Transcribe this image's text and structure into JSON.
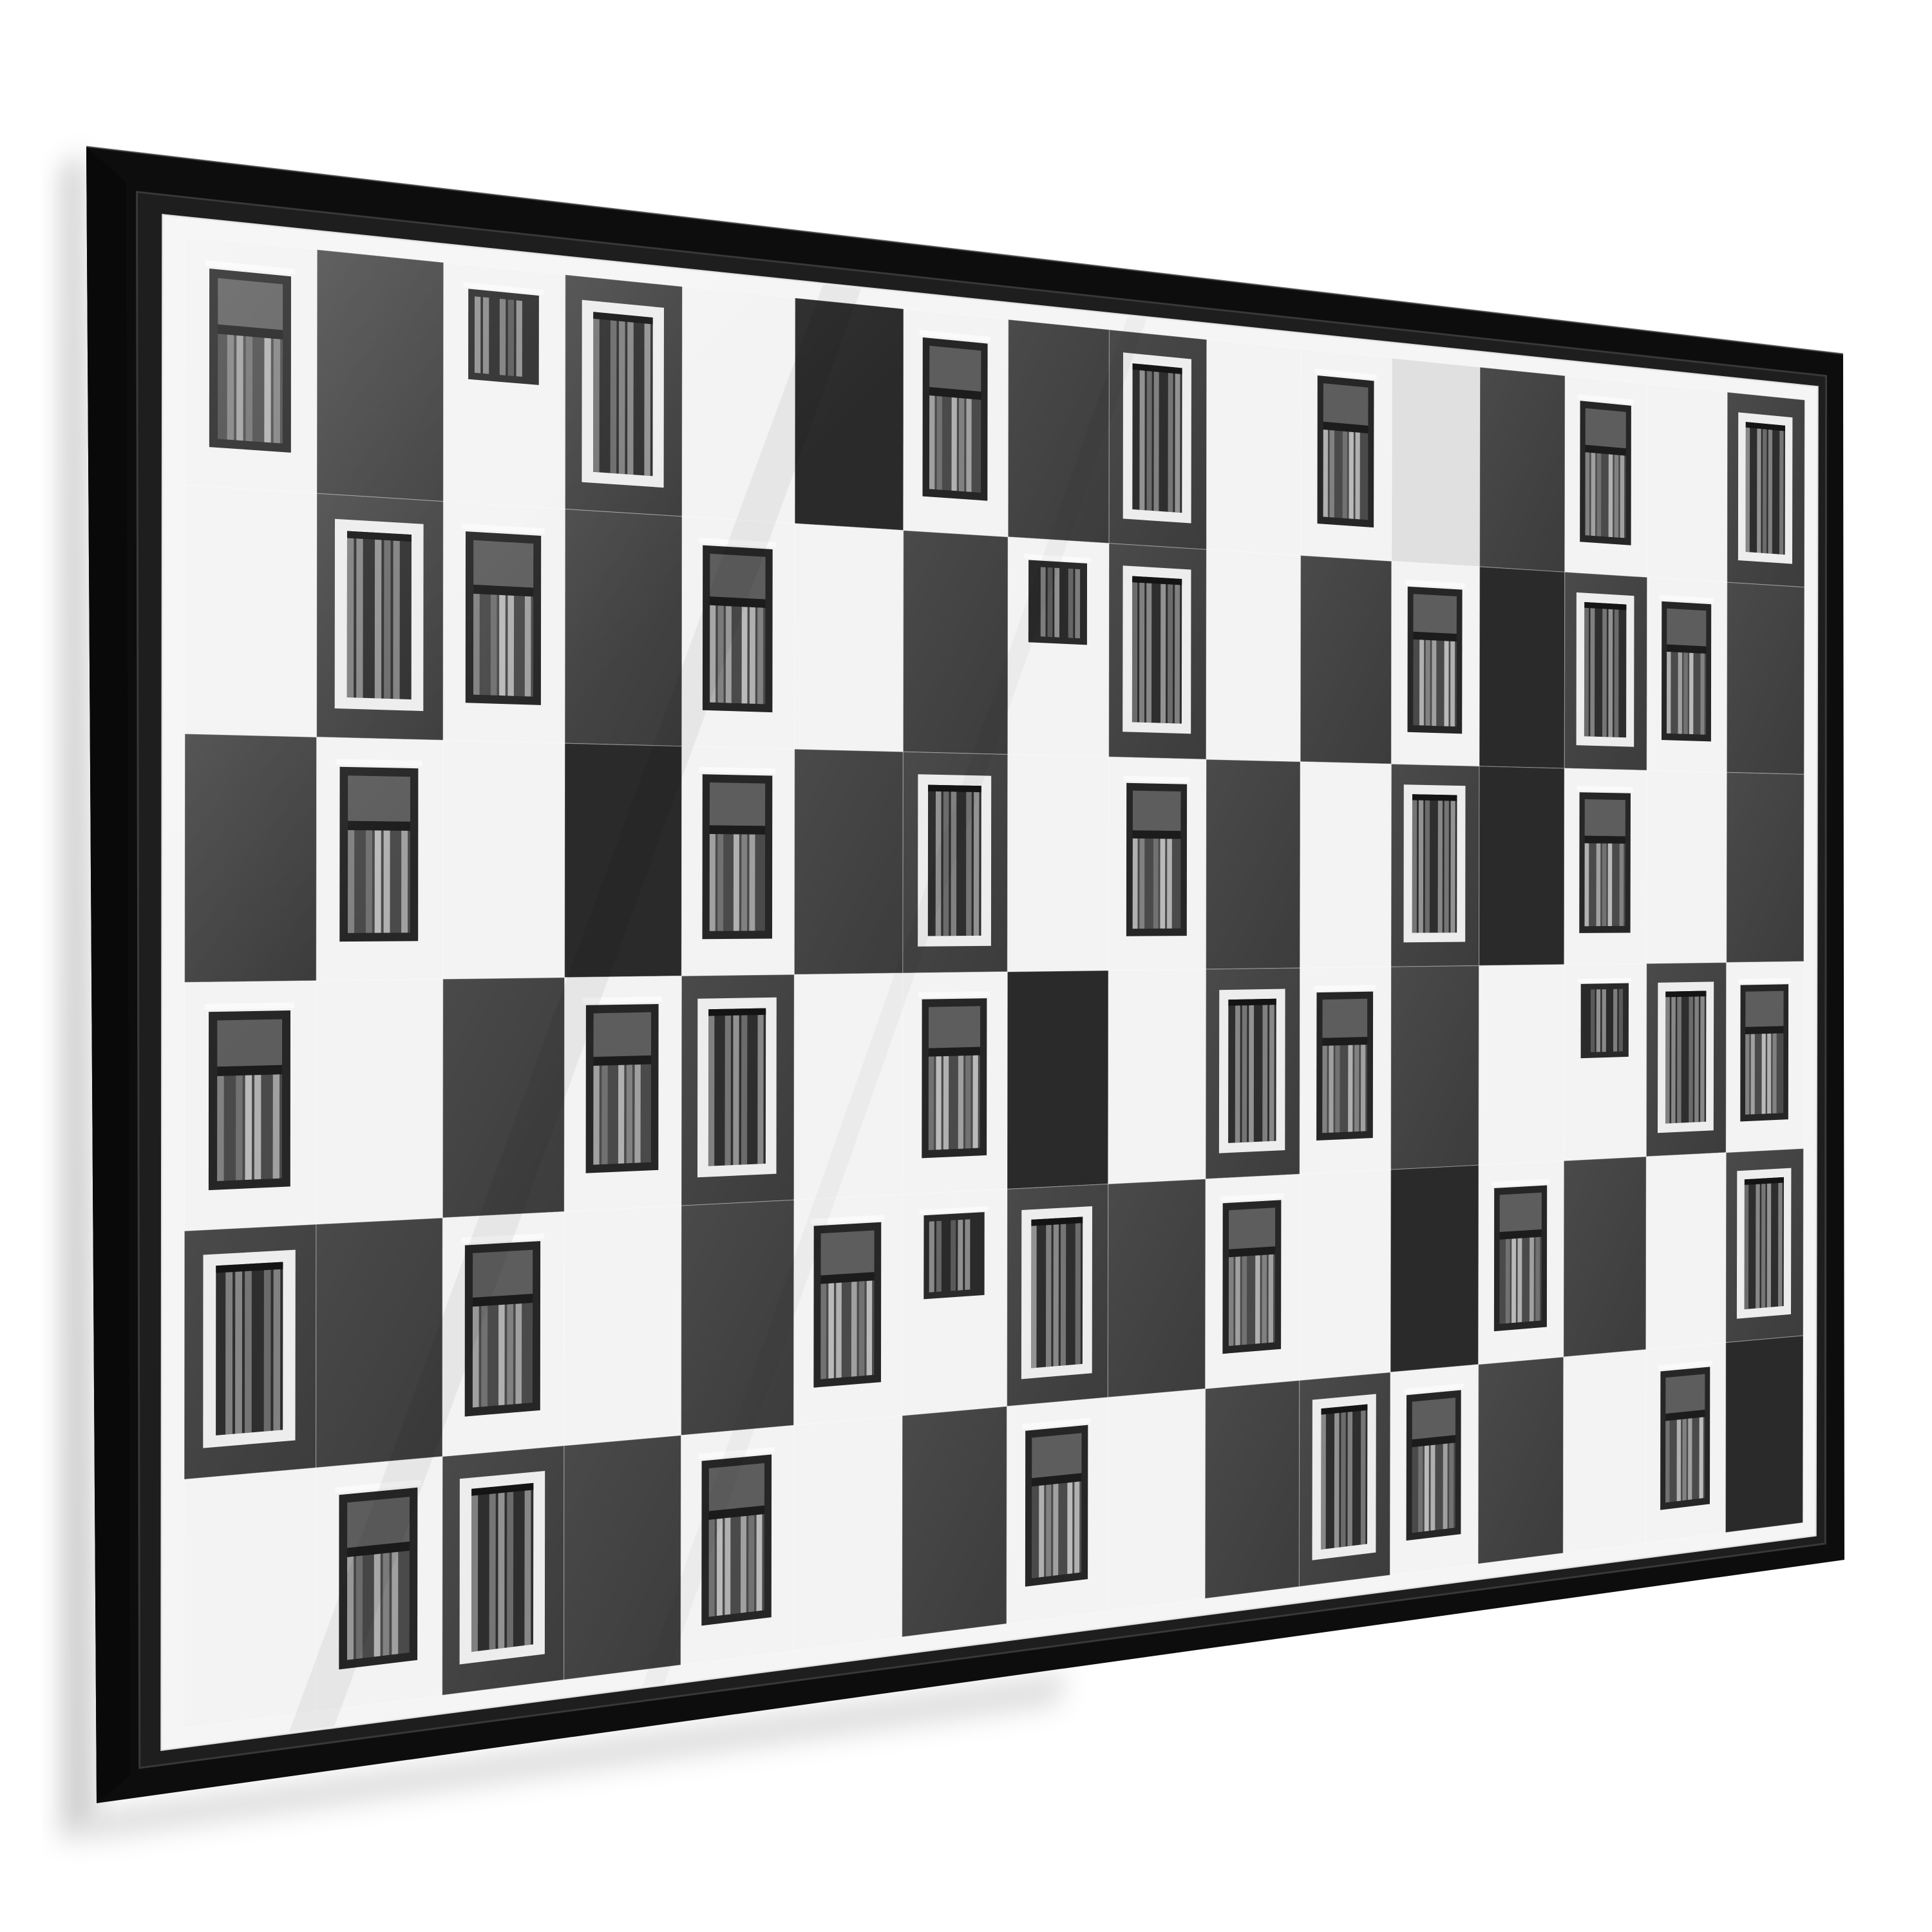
{
  "scene": {
    "wall_color": "#ffffff",
    "shadow_color": "#000000"
  },
  "poster": {
    "frame_color": "#0d0d0d",
    "frame_side_color": "#090909",
    "frame_lip_color": "#1e1e1e",
    "frame_lip_highlight": "#3c3c3c",
    "glass_edge_color": "#f2f2f2",
    "print_paper_color": "#f5f5f5",
    "outer_quad": [
      [
        134,
        228
      ],
      [
        2862,
        550
      ],
      [
        2864,
        2422
      ],
      [
        150,
        2800
      ]
    ],
    "inner_quad": [
      [
        253,
        334
      ],
      [
        2822,
        601
      ],
      [
        2819,
        2384
      ],
      [
        251,
        2717
      ]
    ],
    "source_size": [
      2560,
      2100
    ],
    "print_margin": 26,
    "grid": {
      "cols": 16,
      "rows": 6,
      "cells": [
        "KDSCWBKDCWKLDKWC",
        "WCKDKWDSCWDKBCKD",
        "DKWBKDCWKDWCBKWD",
        "KWDKCWKBWCKDWSCK",
        "CDKWDKSCDKWBKDWC",
        "WKCDKWDKWDCKDWKB"
      ],
      "legend": {
        "W": "white-panel",
        "L": "light-gray-panel",
        "D": "dark-gray-panel",
        "B": "black-panel",
        "K": "white-panel-dark-window-with-curtains",
        "C": "dark-panel-white-framed-curtain-window",
        "S": "white-panel-small-dark-window",
        "T": "black-panel-small-white-window"
      }
    },
    "palette": {
      "white_panel": "#f3f3f3",
      "light_panel": "#e0e0e0",
      "dark_panel_hi": "#4a4a4a",
      "dark_panel_lo": "#3c3c3c",
      "black_panel": "#2a2a2a",
      "window_frame_dark": "#262626",
      "window_glass_upper": "#5d5d5d",
      "window_transom": "#1c1c1c",
      "window_glass_base": "#4a4a4a",
      "window_frame_light": "#ededed",
      "window_glass_night": "#2e2e2e",
      "sill_highlight": "#fafafa",
      "seam_line": "#ffffff",
      "curtains_on_white": [
        "#c9c9c9",
        "#8e8e8e",
        "#b5b5b5",
        "#7b7b7b",
        "#d6d6d6"
      ],
      "curtains_on_dark": [
        "#d2d2d2",
        "#b0b0b0",
        "#e6e6e6",
        "#9e9e9e",
        "#c4c4c4"
      ]
    },
    "reflection": {
      "sheen_opacity": 0.16,
      "streak_opacity": 0.05
    }
  }
}
